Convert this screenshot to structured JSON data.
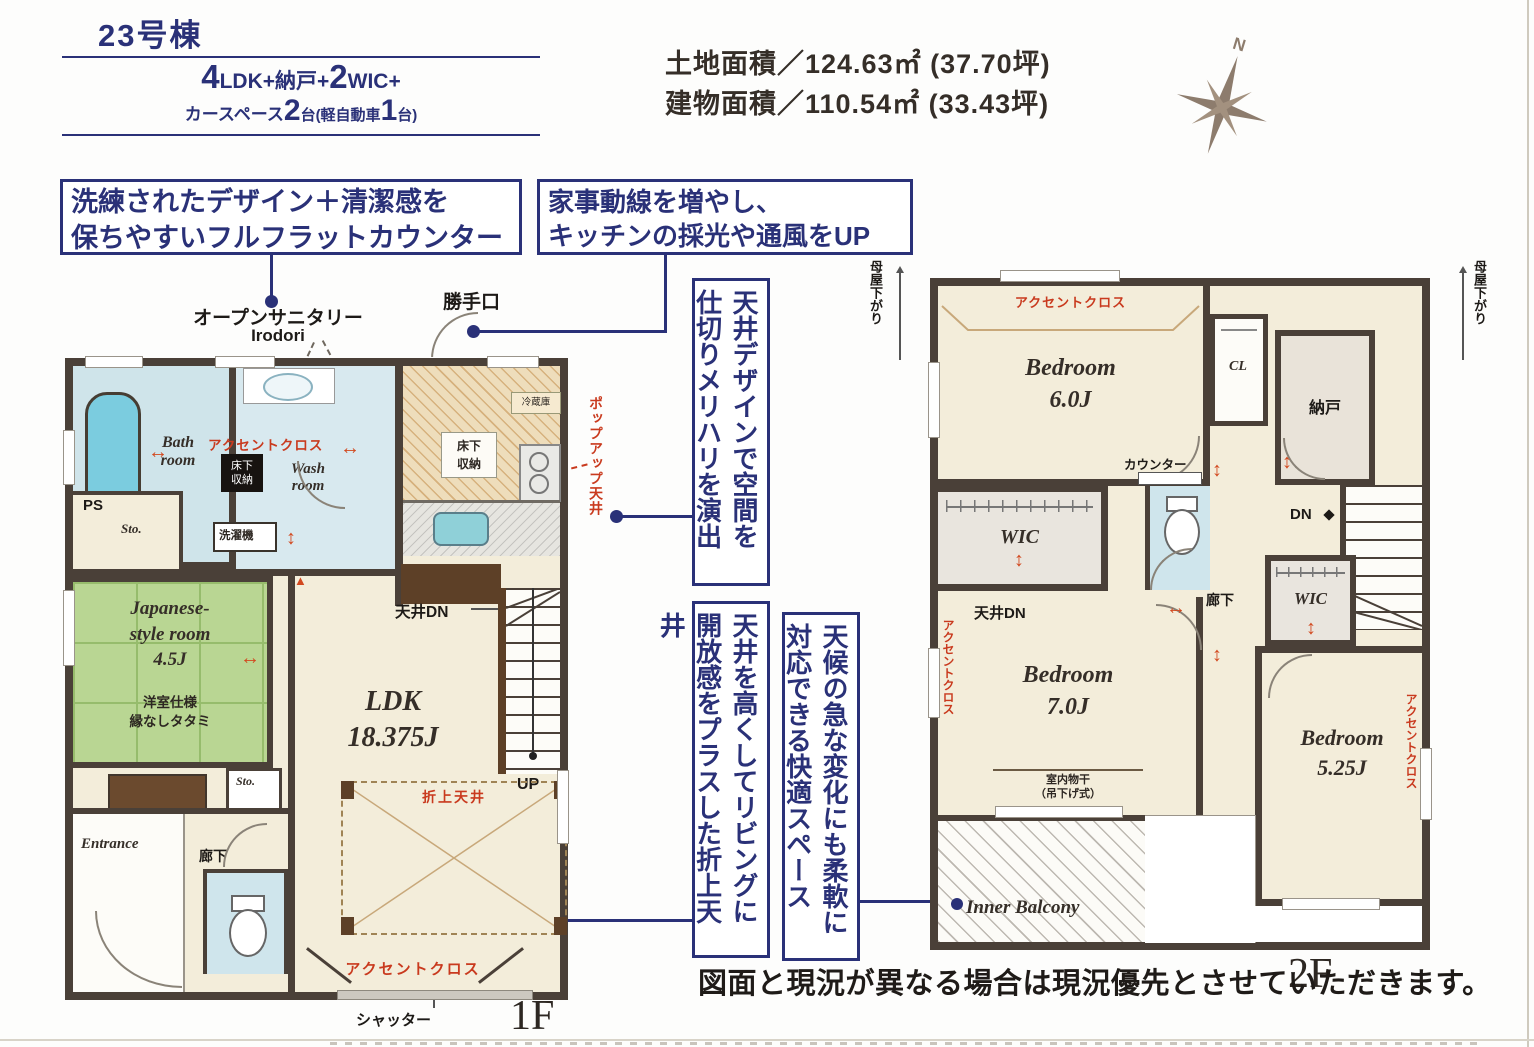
{
  "header": {
    "building": "23号棟",
    "land_area": "土地面積／124.63㎡ (37.70坪)",
    "building_area": "建物面積／110.54㎡ (33.43坪)",
    "compass": "N"
  },
  "plan_summary": {
    "n1": "4",
    "t1": "LDK+納戸+",
    "n2": "2",
    "t2": "WIC+",
    "s1": "カースペース",
    "m1": "2",
    "s2": "台(軽自動車",
    "m2": "1",
    "s3": "台)"
  },
  "callouts": {
    "counter": "洗練されたデザイン＋清潔感を\n保ちやすいフルフラットカウンター",
    "kitchen": "家事動線を増やし、\nキッチンの採光や通風をUP",
    "ceiling_design": "天井デザインで空間を\n仕切りメリハリを演出",
    "oriage_ceiling": "天井を高くしてリビングに\n開放感をプラスした折上天井",
    "inner_balcony": "天候の急な変化にも柔軟に\n対応できる快適スペース"
  },
  "floor1": {
    "label": "1F",
    "open_sanitary": "オープンサニタリー",
    "irodori": "Irodori",
    "kattegu": "勝手口",
    "bath": "Bath\nroom",
    "wash": "Wash\nroom",
    "accent_wash": "アクセントクロス",
    "yukashita_wash": "床下\n収納",
    "sentakuki": "洗濯機",
    "ps": "PS",
    "sto1": "Sto.",
    "japanese_room": "Japanese-\nstyle room\n4.5J",
    "tatami_note": "洋室仕様\n縁なしタタミ",
    "sto2": "Sto.",
    "entrance": "Entrance",
    "hallway": "廊下",
    "fridge": "冷蔵庫",
    "yukashita_kitchen": "床下\n収納",
    "popup_ceiling": "ポップアップ天井",
    "tenjo_dn": "天井DN",
    "ldk": "LDK\n18.375J",
    "up": "UP",
    "oriage": "折上天井",
    "accent_bottom": "アクセントクロス",
    "shutter": "シャッター"
  },
  "floor2": {
    "label": "2F",
    "moya_left": "母屋下がり",
    "moya_right": "母屋下がり",
    "accent_top": "アクセントクロス",
    "bedroom6": "Bedroom\n6.0J",
    "cl": "CL",
    "nando": "納戸",
    "counter": "カウンター",
    "dn": "DN",
    "wic1": "WIC",
    "tenjo_dn": "天井DN",
    "accent_left": "アクセントクロス",
    "bedroom7": "Bedroom\n7.0J",
    "monohoshi": "室内物干\n（吊下げ式）",
    "hallway": "廊下",
    "wic2": "WIC",
    "bedroom525": "Bedroom\n5.25J",
    "accent_right": "アクセントクロス",
    "inner_balcony": "Inner Balcony"
  },
  "footer": {
    "disclaimer": "図面と現況が異なる場合は現況優先とさせていただきます。"
  },
  "colors": {
    "navy": "#2a3178",
    "accent_red": "#c93a1e",
    "wall": "#4a4038",
    "tatami_green": "#b9d693",
    "wet_blue": "#cfe5ec",
    "cream_floor": "#f3edda"
  }
}
